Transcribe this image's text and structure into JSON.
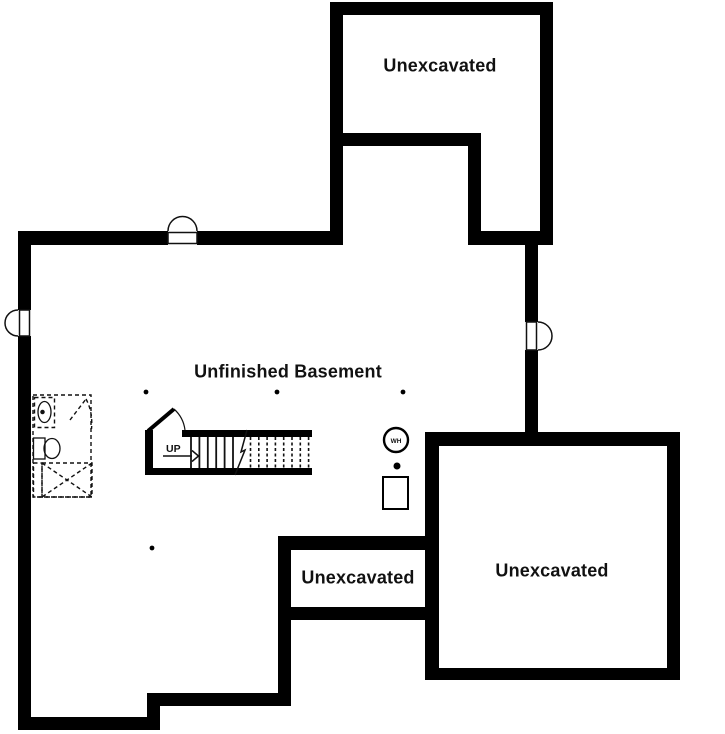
{
  "rooms": [
    {
      "id": "unexcavated-top",
      "label": "Unexcavated"
    },
    {
      "id": "unfinished-basement",
      "label": "Unfinished Basement"
    },
    {
      "id": "unexcavated-middle",
      "label": "Unexcavated"
    },
    {
      "id": "unexcavated-bottom-right",
      "label": "Unexcavated"
    }
  ],
  "stairs": {
    "direction_label": "UP"
  },
  "equipment": {
    "water_heater_label": "WH"
  },
  "symbols": [
    "window-well-icon",
    "door-swing-icon",
    "stair-run",
    "stair-break-line",
    "future-bathroom-rough-in",
    "water-heater-symbol",
    "floor-drain-dot",
    "furnace-symbol",
    "support-post-dot"
  ],
  "colors": {
    "wall": "#000000",
    "line": "#111111",
    "background": "#ffffff",
    "text": "#111111"
  }
}
